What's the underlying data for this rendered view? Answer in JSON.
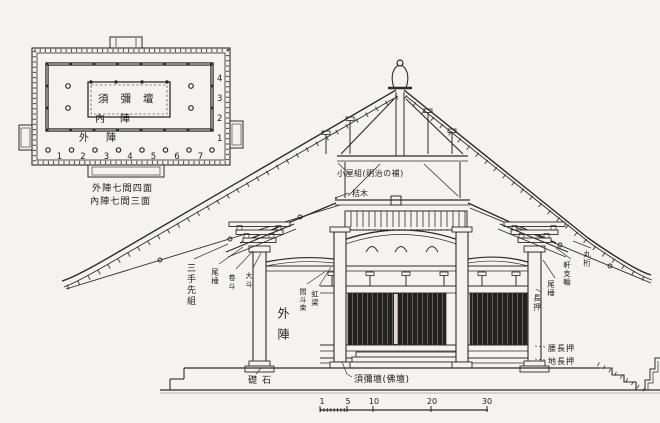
{
  "page": {
    "background": "#f5f3ef",
    "ink": "#2e2b26"
  },
  "floor_plan": {
    "altar_label": "須彌壇",
    "inner_zone_label": "內陣",
    "outer_zone_label": "外陣",
    "bay_numbers_bottom": [
      "1",
      "2",
      "3",
      "4",
      "5",
      "6",
      "7"
    ],
    "bay_numbers_right": [
      "4",
      "3",
      "2",
      "1"
    ],
    "caption_line1": "外陣七間四面",
    "caption_line2": "內陣七間三面"
  },
  "cross_section": {
    "labels": {
      "roof_frame": "小屋組(明治の補)",
      "lever_beam": "桔木",
      "bracket_set": "三手先組",
      "tail_rafter_left": "尾棰",
      "small_block": "卷斗",
      "large_block": "大斗",
      "strut": "間斗束",
      "rainbow_beam": "虹梁",
      "round_purlin": "丸桁",
      "eave_shirin": "軒支輪",
      "tail_rafter_right": "尾棰",
      "nageshi": "長押",
      "waist_nageshi": "腰長押",
      "ground_nageshi": "地長押",
      "outer_sanctum": "外陣",
      "foundation_stone": "礎石",
      "altar": "須彌壇(佛壇)"
    },
    "scale_bar": {
      "ticks": [
        "1",
        "5",
        "10",
        "20",
        "30"
      ]
    }
  }
}
